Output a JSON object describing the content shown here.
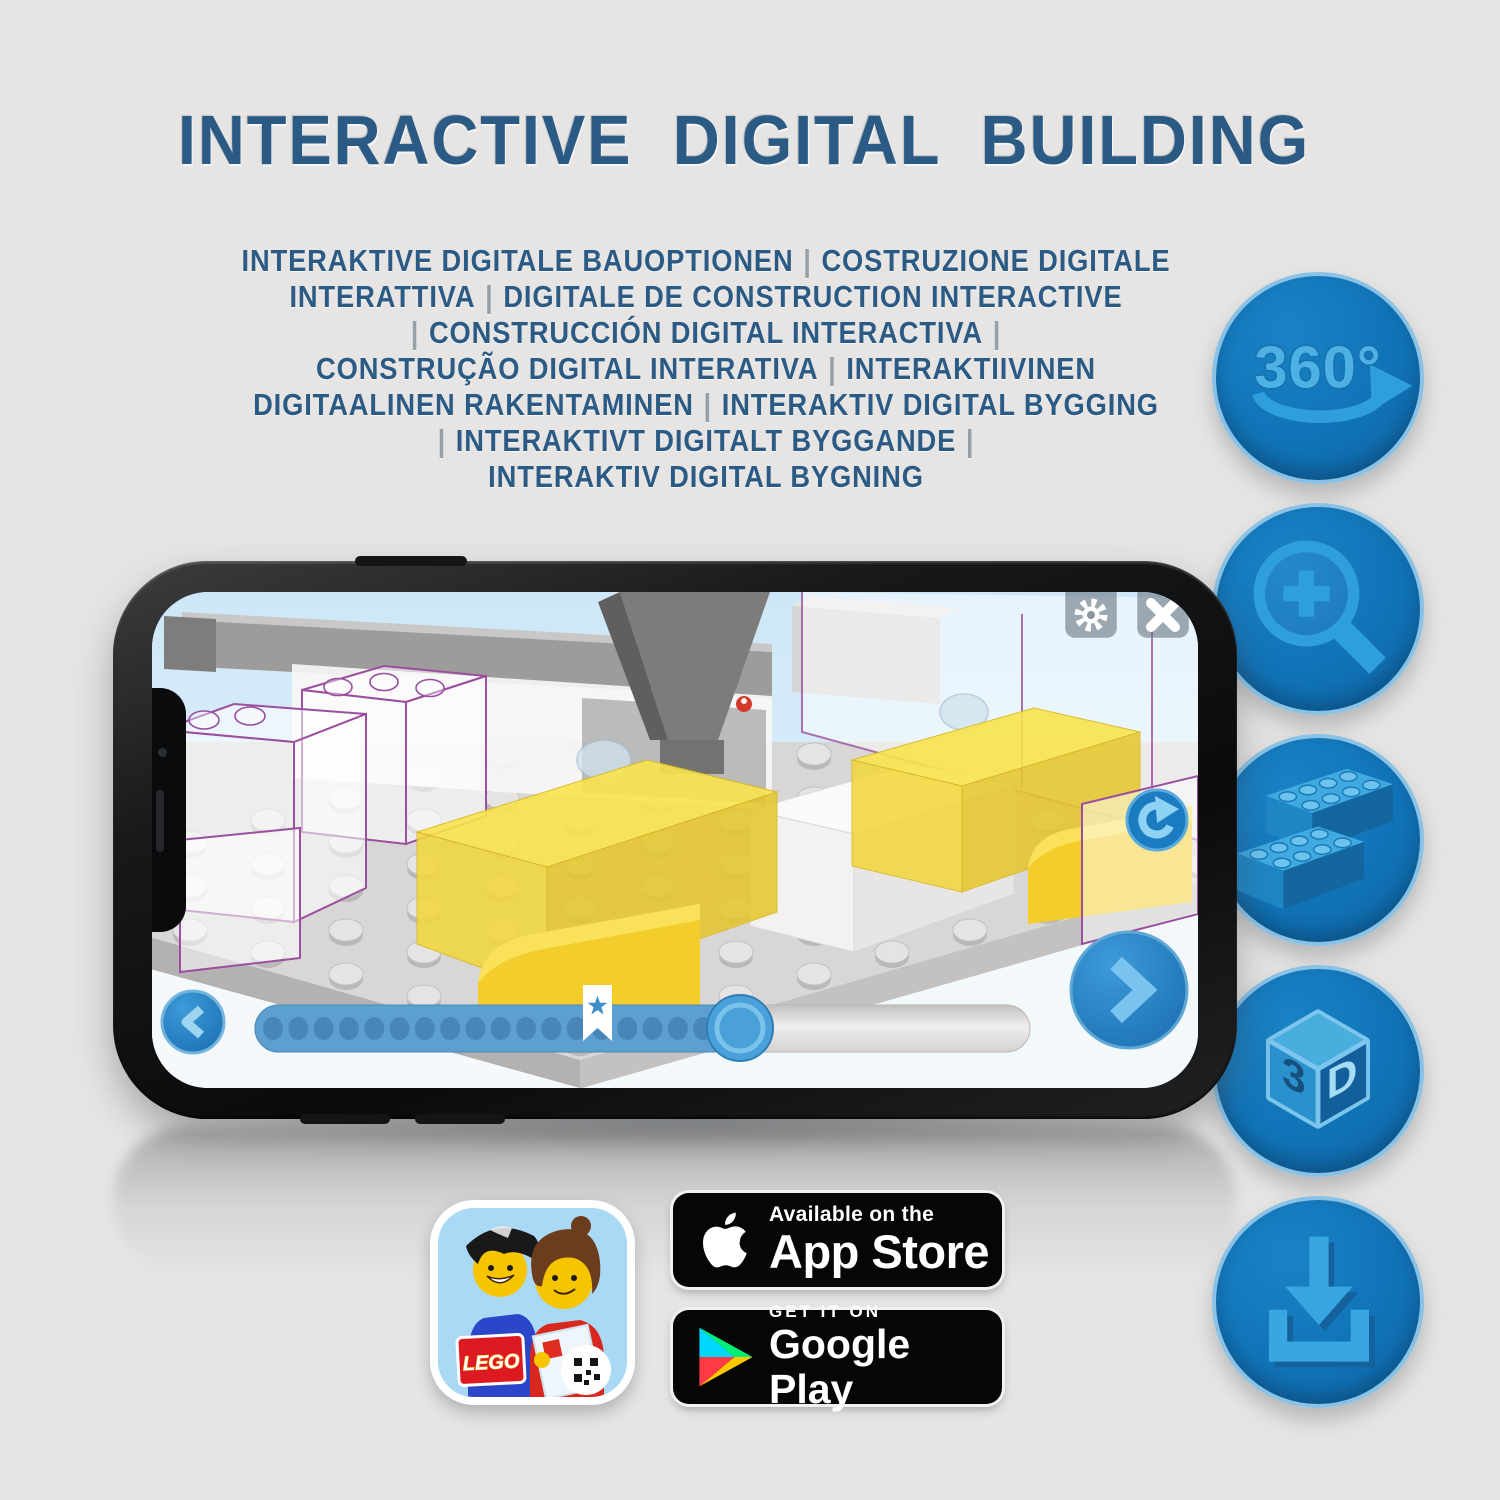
{
  "title": {
    "text": "INTERACTIVE DIGITAL BUILDING"
  },
  "subtitle": {
    "lines": [
      "INTERAKTIVE DIGITALE BAUOPTIONEN | COSTRUZIONE DIGITALE",
      "INTERATTIVA | DIGITALE DE CONSTRUCTION INTERACTIVE",
      "| CONSTRUCCIÓN DIGITAL INTERACTIVA |",
      "CONSTRUÇÃO DIGITAL INTERATIVA | INTERAKTIIVINEN",
      "DIGITAALINEN RAKENTAMINEN | INTERAKTIV DIGITAL BYGGING",
      "| INTERAKTIVT DIGITALT BYGGANDE |",
      "INTERAKTIV DIGITAL BYGNING"
    ]
  },
  "features": [
    {
      "name": "360-rotation-icon",
      "label": "360°"
    },
    {
      "name": "zoom-in-icon"
    },
    {
      "name": "brick-icon"
    },
    {
      "name": "3d-view-icon",
      "face_left": "3",
      "face_right": "D"
    },
    {
      "name": "download-icon"
    }
  ],
  "phone_app": {
    "slider": {
      "dots": 19,
      "progress_percent": 62
    },
    "icons": [
      "gear-icon",
      "close-icon",
      "reset-rotation-icon",
      "previous-chevron-icon",
      "next-chevron-icon",
      "bookmark-star-icon"
    ]
  },
  "badges": {
    "app_store": {
      "line1": "Available on the",
      "line2": "App Store"
    },
    "google_play": {
      "line1": "GET IT ON",
      "line2": "Google Play"
    },
    "lego_app": {
      "logo_text": "LEGO"
    }
  },
  "colors": {
    "title_blue": "#2b5b84",
    "feature_circle_blue": "#1173b7",
    "feature_glyph_blue": "#2f9fdb",
    "slider_fill_blue": "#5d9fd1",
    "ghost_outline_purple": "#9a4f9f",
    "brick_yellow": "#f2cd2b"
  }
}
